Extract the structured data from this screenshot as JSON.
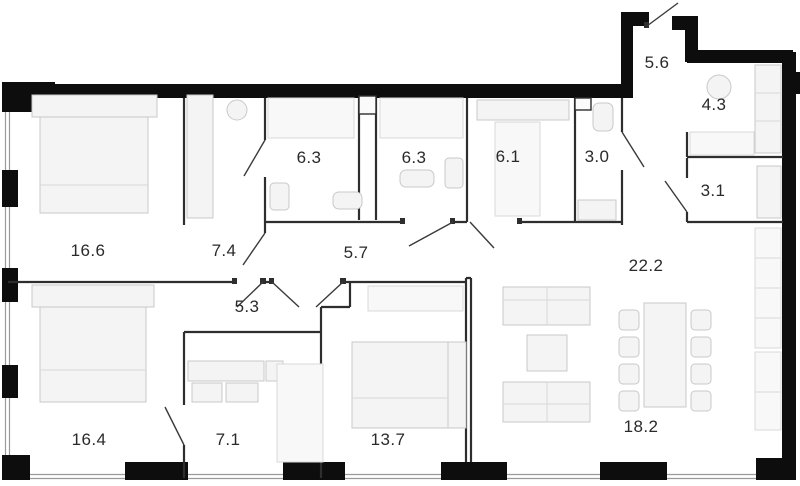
{
  "plan": {
    "title": "apartment-floor-plan",
    "colors": {
      "background": "#ffffff",
      "structural_wall": "#0d0d0d",
      "partition_wall": "#2e2e2e",
      "window_line": "#9a9a9a",
      "furniture_fill": "#f4f4f4",
      "furniture_stroke": "#c9c9c9",
      "label_text": "#2a2a2a"
    }
  },
  "rooms": [
    {
      "area": "16.6"
    },
    {
      "area": "7.4"
    },
    {
      "area": "6.3"
    },
    {
      "area": "6.3"
    },
    {
      "area": "6.1"
    },
    {
      "area": "3.0"
    },
    {
      "area": "5.6"
    },
    {
      "area": "4.3"
    },
    {
      "area": "3.1"
    },
    {
      "area": "5.7"
    },
    {
      "area": "22.2"
    },
    {
      "area": "5.3"
    },
    {
      "area": "16.4"
    },
    {
      "area": "7.1"
    },
    {
      "area": "13.7"
    },
    {
      "area": "18.2"
    }
  ],
  "furniture_legend": [
    "bed",
    "wardrobe",
    "shower",
    "toilet",
    "sink",
    "washer",
    "sofa",
    "coffee-table",
    "dining-table",
    "chair",
    "kitchen-counter",
    "shelf"
  ]
}
